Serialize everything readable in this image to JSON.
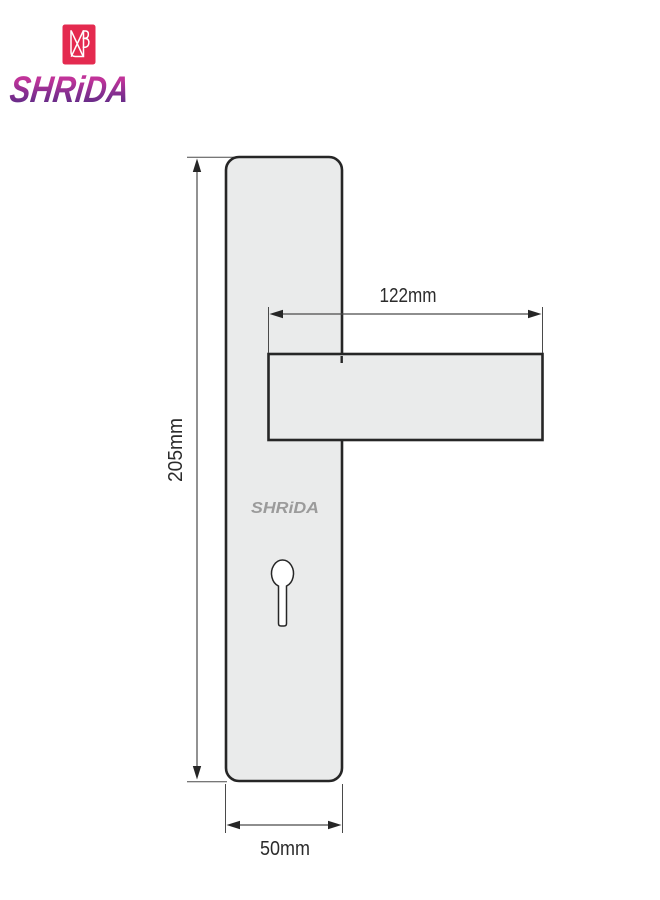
{
  "brand": {
    "name": "SHRIDA",
    "wordmark_text": "SHRiDA",
    "colors": {
      "mark_red": "#e42a4f",
      "wordmark_top": "#c03399",
      "wordmark_bottom": "#5c2b85"
    }
  },
  "diagram": {
    "plate_brand_label": "SHRiDA",
    "labels": {
      "height": "205mm",
      "handle_length": "122mm",
      "width": "50mm"
    },
    "colors": {
      "metal_fill": "#eaebeb",
      "outline": "#262626",
      "dim_line": "#4a4a4a",
      "dim_text": "#2b2b2b",
      "plate_label_gray": "#9b9b9b",
      "keyhole_fill": "#ffffff"
    }
  }
}
